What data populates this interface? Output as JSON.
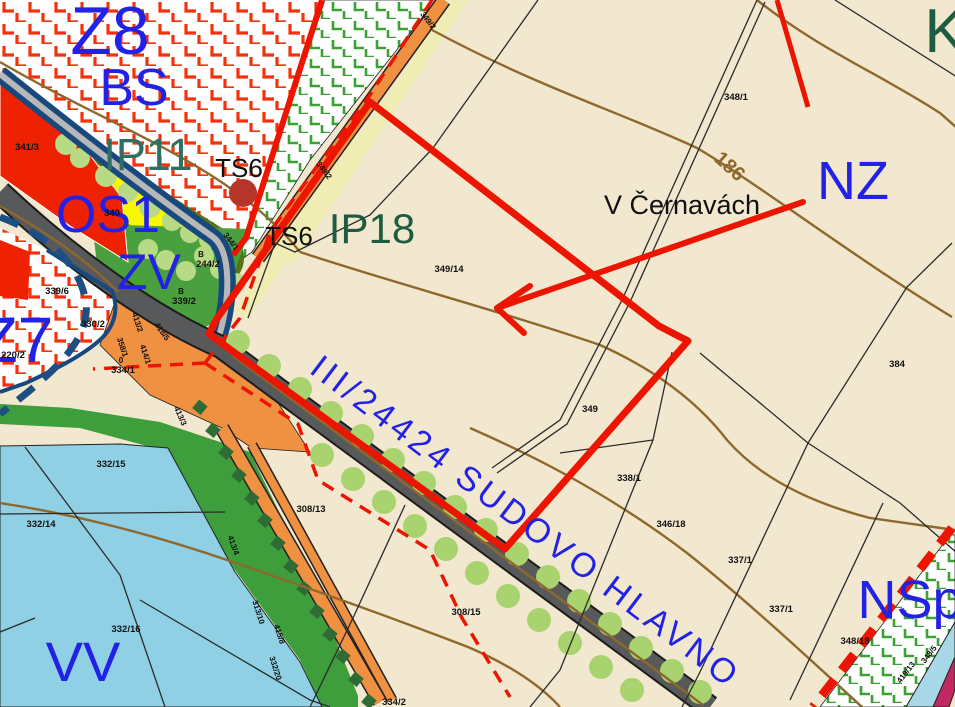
{
  "map": {
    "kind": "municipal zoning plan (územní plán) detail",
    "place_name": "V Černavách",
    "road_name": "III/24424 SUDOVO HLAVNO",
    "contour_elevation": "186",
    "zones_visible": [
      "Z8",
      "BS",
      "IP11",
      "OS1",
      "ZV",
      "Z7",
      "IP18",
      "NZ",
      "K",
      "NSp",
      "VV"
    ],
    "infrastructure_points": [
      "TS6",
      "TS6"
    ]
  },
  "colors": {
    "background_beige": "#f2e7cf",
    "boundary_red": "#ee1500",
    "crosshatch_red": "#f5320c",
    "crosshatch_green": "#3aa133",
    "zone_label_blue": "#2222e6",
    "zone_label_green": "#1d5c40",
    "zone_label_teal": "#2d6f62",
    "water_blue": "#8fd0e5",
    "road_gray": "#58595b",
    "navy_corridor": "#17497e",
    "orange_path": "#f09041",
    "contour_brown": "#8f682c",
    "os1_yellow": "#f8f800",
    "olive_band": "#567416",
    "zv_green": "#4aa03e",
    "tree_green": "#a9d36e",
    "crimson_strip": "#c22862",
    "light_blue_strip": "#a8d8e8",
    "ts_circle_red": "#b5352a"
  },
  "labels": [
    {
      "text": "Z8",
      "x": 110,
      "y": 54,
      "fs": 68,
      "cls": "lbl-blue",
      "name": "zone-label-z8"
    },
    {
      "text": "BS",
      "x": 134,
      "y": 105,
      "fs": 52,
      "cls": "lbl-blue",
      "name": "zone-label-bs"
    },
    {
      "text": "IP11",
      "x": 148,
      "y": 170,
      "fs": 45,
      "cls": "lbl-teal",
      "name": "zone-label-ip11"
    },
    {
      "text": "OS1",
      "x": 108,
      "y": 232,
      "fs": 52,
      "cls": "lbl-blue",
      "name": "zone-label-os1"
    },
    {
      "text": "ZV",
      "x": 149,
      "y": 289,
      "fs": 50,
      "cls": "lbl-blue",
      "name": "zone-label-zv"
    },
    {
      "text": "Z7",
      "x": 16,
      "y": 362,
      "fs": 64,
      "cls": "lbl-blue",
      "name": "zone-label-z7"
    },
    {
      "text": "IP18",
      "x": 372,
      "y": 243,
      "fs": 42,
      "cls": "lbl-green",
      "name": "zone-label-ip18"
    },
    {
      "text": "NZ",
      "x": 853,
      "y": 199,
      "fs": 54,
      "cls": "lbl-blue",
      "name": "zone-label-nz"
    },
    {
      "text": "K",
      "x": 945,
      "y": 52,
      "fs": 62,
      "cls": "lbl-green",
      "name": "zone-label-k"
    },
    {
      "text": "NSp",
      "x": 910,
      "y": 618,
      "fs": 54,
      "cls": "lbl-blue",
      "name": "zone-label-nsp"
    },
    {
      "text": "VV",
      "x": 83,
      "y": 681,
      "fs": 56,
      "cls": "lbl-blue",
      "name": "zone-label-vv"
    },
    {
      "text": "TS6",
      "x": 239,
      "y": 177,
      "fs": 26,
      "cls": "lbl-black",
      "name": "ts6-label-1"
    },
    {
      "text": "TS6",
      "x": 289,
      "y": 245,
      "fs": 26,
      "cls": "lbl-black",
      "name": "ts6-label-2"
    },
    {
      "text": "V Černavách",
      "x": 682,
      "y": 214,
      "fs": 27,
      "cls": "lbl-black",
      "name": "place-name-label"
    },
    {
      "text": "186",
      "x": 713,
      "y": 160,
      "fs": 20,
      "rot": 42,
      "cls": "lbl-brown",
      "anchor": "start",
      "name": "contour-label-186"
    },
    {
      "text": "III/24424 SUDOVO HLAVNO",
      "x": 308,
      "y": 372,
      "fs": 34,
      "rot": 37,
      "cls": "lbl-road",
      "anchor": "start",
      "name": "road-name-label"
    },
    {
      "text": "341/3",
      "x": 27,
      "y": 150,
      "fs": 9.5,
      "cls": "lbl-parcel",
      "name": "parcel-341-3"
    },
    {
      "text": "340",
      "x": 112,
      "y": 216,
      "fs": 9.5,
      "cls": "lbl-parcel",
      "name": "parcel-340"
    },
    {
      "text": "348/1",
      "x": 736,
      "y": 100,
      "fs": 9.5,
      "cls": "lbl-parcel",
      "name": "parcel-348-1"
    },
    {
      "text": "349/14",
      "x": 449,
      "y": 272,
      "fs": 9.5,
      "cls": "lbl-parcel",
      "name": "parcel-349-14"
    },
    {
      "text": "384",
      "x": 897,
      "y": 367,
      "fs": 9.5,
      "cls": "lbl-parcel",
      "name": "parcel-384"
    },
    {
      "text": "349",
      "x": 590,
      "y": 412,
      "fs": 9.5,
      "cls": "lbl-parcel",
      "name": "parcel-349"
    },
    {
      "text": "338/1",
      "x": 629,
      "y": 481,
      "fs": 9.5,
      "cls": "lbl-parcel",
      "name": "parcel-338-1"
    },
    {
      "text": "346/18",
      "x": 671,
      "y": 527,
      "fs": 9.5,
      "cls": "lbl-parcel",
      "name": "parcel-346-18"
    },
    {
      "text": "337/1",
      "x": 740,
      "y": 563,
      "fs": 9.5,
      "cls": "lbl-parcel",
      "name": "parcel-337-1"
    },
    {
      "text": "337/1",
      "x": 781,
      "y": 612,
      "fs": 9.5,
      "cls": "lbl-parcel",
      "name": "parcel-337-1b"
    },
    {
      "text": "348/18",
      "x": 855,
      "y": 644,
      "fs": 9.5,
      "cls": "lbl-parcel",
      "name": "parcel-348-18"
    },
    {
      "text": "308/13",
      "x": 311,
      "y": 512,
      "fs": 9.5,
      "cls": "lbl-parcel",
      "name": "parcel-308-13"
    },
    {
      "text": "308/15",
      "x": 466,
      "y": 615,
      "fs": 9.5,
      "cls": "lbl-parcel",
      "name": "parcel-308-15"
    },
    {
      "text": "334/2",
      "x": 394,
      "y": 705,
      "fs": 9.5,
      "cls": "lbl-parcel",
      "name": "parcel-334-2"
    },
    {
      "text": "339/6",
      "x": 57,
      "y": 294,
      "fs": 9.5,
      "cls": "lbl-parcel",
      "name": "parcel-339-6"
    },
    {
      "text": "330/2",
      "x": 93,
      "y": 327,
      "fs": 9.5,
      "cls": "lbl-parcel",
      "name": "parcel-330-2"
    },
    {
      "text": "220/2",
      "x": 13,
      "y": 358,
      "fs": 9.5,
      "cls": "lbl-parcel",
      "name": "parcel-220-2"
    },
    {
      "text": "B",
      "x": 181,
      "y": 294,
      "fs": 8,
      "cls": "lbl-parcel",
      "name": "symbol-b-1"
    },
    {
      "text": "339/2",
      "x": 184,
      "y": 304,
      "fs": 9.5,
      "cls": "lbl-parcel",
      "name": "parcel-339-2"
    },
    {
      "text": "B",
      "x": 201,
      "y": 257,
      "fs": 8,
      "cls": "lbl-parcel",
      "name": "symbol-b-2"
    },
    {
      "text": "244/2",
      "x": 208,
      "y": 267,
      "fs": 9.5,
      "cls": "lbl-parcel",
      "name": "parcel-244-2"
    },
    {
      "text": "0",
      "x": 121,
      "y": 363,
      "fs": 8,
      "cls": "lbl-parcel",
      "name": "symbol-0"
    },
    {
      "text": "334/1",
      "x": 123,
      "y": 373,
      "fs": 9.5,
      "cls": "lbl-parcel",
      "name": "parcel-334-1"
    },
    {
      "text": "332/15",
      "x": 111,
      "y": 467,
      "fs": 9.5,
      "cls": "lbl-parcel",
      "name": "parcel-332-15"
    },
    {
      "text": "332/14",
      "x": 41,
      "y": 527,
      "fs": 9.5,
      "cls": "lbl-parcel",
      "name": "parcel-332-14"
    },
    {
      "text": "332/16",
      "x": 126,
      "y": 632,
      "fs": 9.5,
      "cls": "lbl-parcel",
      "name": "parcel-332-16"
    },
    {
      "text": "349/2",
      "x": 426,
      "y": 22,
      "fs": 8,
      "rot": 52,
      "cls": "lbl-parcel",
      "name": "parcel-349-2"
    },
    {
      "text": "349/2",
      "x": 322,
      "y": 172,
      "fs": 8,
      "rot": 52,
      "cls": "lbl-parcel",
      "name": "parcel-349-2b"
    },
    {
      "text": "344/1",
      "x": 229,
      "y": 243,
      "fs": 8,
      "rot": 52,
      "cls": "lbl-parcel",
      "name": "parcel-344-1"
    },
    {
      "text": "413/2",
      "x": 135,
      "y": 323,
      "fs": 8,
      "rot": 72,
      "cls": "lbl-parcel",
      "name": "parcel-413-2"
    },
    {
      "text": "358/1",
      "x": 120,
      "y": 348,
      "fs": 8,
      "rot": 72,
      "cls": "lbl-parcel",
      "name": "parcel-358-1"
    },
    {
      "text": "414/1",
      "x": 143,
      "y": 355,
      "fs": 8,
      "rot": 72,
      "cls": "lbl-parcel",
      "name": "parcel-414-1"
    },
    {
      "text": "418/5",
      "x": 160,
      "y": 333,
      "fs": 8,
      "rot": 55,
      "cls": "lbl-parcel",
      "name": "parcel-418-5"
    },
    {
      "text": "413/3",
      "x": 178,
      "y": 417,
      "fs": 8,
      "rot": 66,
      "cls": "lbl-parcel",
      "name": "parcel-413-3"
    },
    {
      "text": "413/4",
      "x": 231,
      "y": 546,
      "fs": 8,
      "rot": 70,
      "cls": "lbl-parcel",
      "name": "parcel-413-4"
    },
    {
      "text": "313/10",
      "x": 256,
      "y": 613,
      "fs": 8,
      "rot": 72,
      "cls": "lbl-parcel",
      "name": "parcel-313-10"
    },
    {
      "text": "415/8",
      "x": 277,
      "y": 635,
      "fs": 8,
      "rot": 72,
      "cls": "lbl-parcel",
      "name": "parcel-415-8"
    },
    {
      "text": "332/20",
      "x": 273,
      "y": 669,
      "fs": 8,
      "rot": 72,
      "cls": "lbl-parcel",
      "name": "parcel-332-20"
    },
    {
      "text": "419/13",
      "x": 908,
      "y": 674,
      "fs": 8,
      "rot": -52,
      "cls": "lbl-parcel",
      "name": "parcel-419-13"
    },
    {
      "text": "348/5",
      "x": 931,
      "y": 656,
      "fs": 8,
      "rot": -52,
      "cls": "lbl-parcel",
      "name": "parcel-348-5"
    }
  ]
}
